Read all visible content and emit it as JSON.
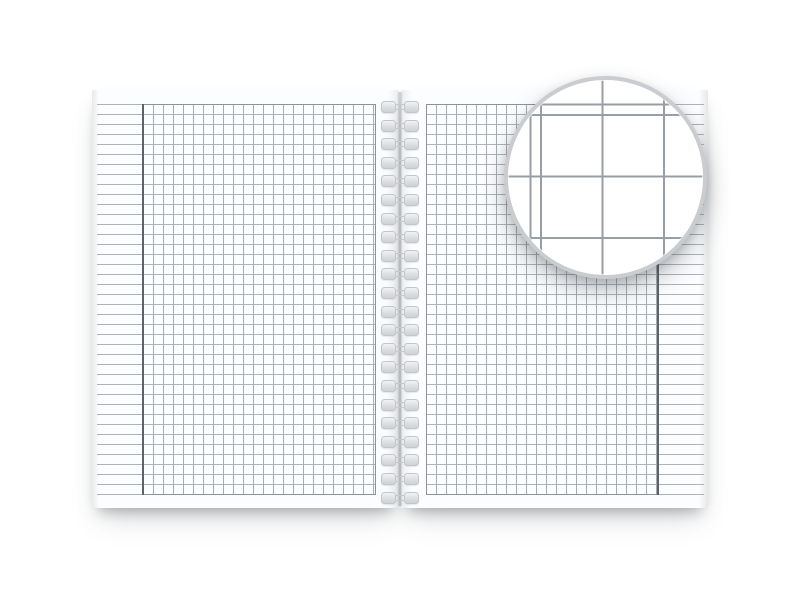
{
  "scene": {
    "type": "product-mockup",
    "description": "Open spiral-bound notebook with square-grid (graph) paper pages and a round magnified detail of the grid",
    "background_color": "#ffffff"
  },
  "notebook": {
    "paper_color": "#fcfdfe",
    "pages": [
      {
        "side": "left",
        "paper": "square grid",
        "margin_position": "left",
        "margin_content": "horizontal ruled lines only"
      },
      {
        "side": "right",
        "paper": "square grid",
        "margin_position": "right",
        "margin_content": "horizontal ruled lines only"
      }
    ],
    "grid": {
      "cell_px": 10,
      "rows": 39,
      "columns_per_page": 23,
      "grid_line_color": "#a6abb2",
      "ruled_line_color": "#aeb3ba",
      "grid_border_color": "#8d9299",
      "margin_line_color": "#5d6269"
    },
    "spiral": {
      "loop_count": 22,
      "first_loop_y_px": 101,
      "loop_spacing_px": 18.6,
      "coil_color": "#dcdee1",
      "coil_border_color": "#c2c5c9",
      "wire_color": "#c6c9cc"
    }
  },
  "magnifier": {
    "shape": "circle",
    "diameter_px": 203,
    "center_x_px": 606,
    "center_y_px": 178,
    "cell_px": 61.5,
    "line_color": "#989ea5",
    "line_width_px": 2,
    "rim_color": "#cacccf",
    "fill_color": "#ffffff"
  }
}
